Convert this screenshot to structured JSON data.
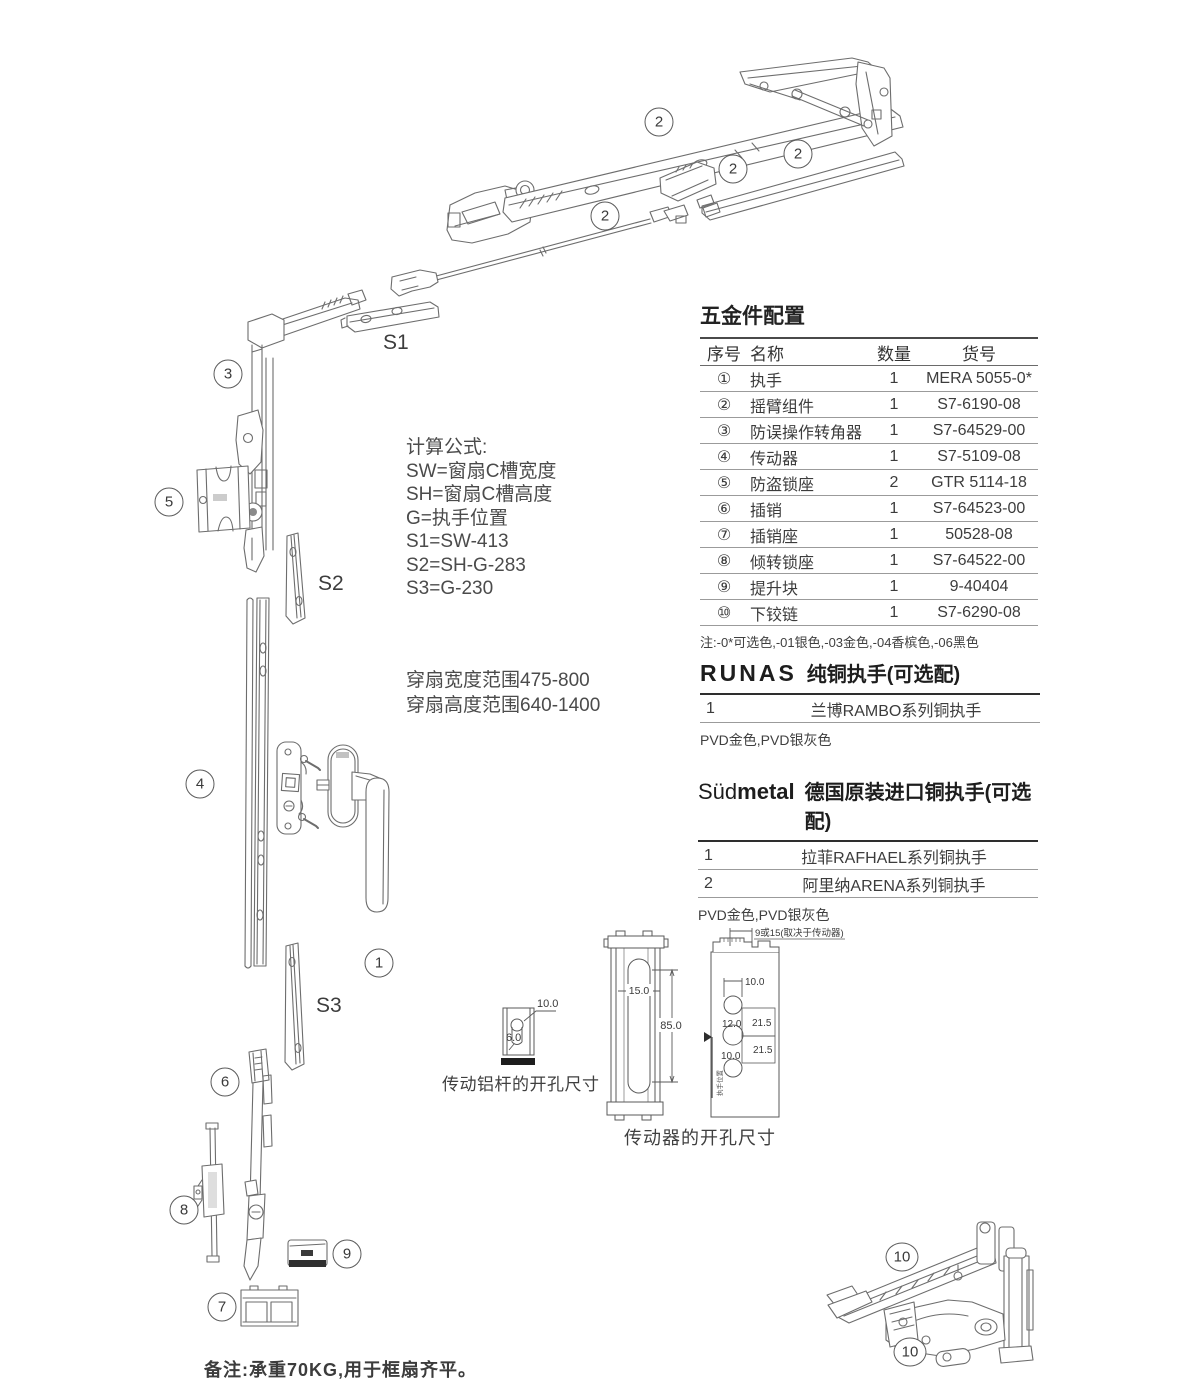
{
  "hardware_table": {
    "title": "五金件配置",
    "columns": [
      "序号",
      "名称",
      "数量",
      "货号"
    ],
    "rows": [
      {
        "no": "①",
        "name": "执手",
        "qty": "1",
        "code": "MERA 5055-0*"
      },
      {
        "no": "②",
        "name": "摇臂组件",
        "qty": "1",
        "code": "S7-6190-08"
      },
      {
        "no": "③",
        "name": "防误操作转角器",
        "qty": "1",
        "code": "S7-64529-00"
      },
      {
        "no": "④",
        "name": "传动器",
        "qty": "1",
        "code": "S7-5109-08"
      },
      {
        "no": "⑤",
        "name": "防盗锁座",
        "qty": "2",
        "code": "GTR 5114-18"
      },
      {
        "no": "⑥",
        "name": "插销",
        "qty": "1",
        "code": "S7-64523-00"
      },
      {
        "no": "⑦",
        "name": "插销座",
        "qty": "1",
        "code": "50528-08"
      },
      {
        "no": "⑧",
        "name": "倾转锁座",
        "qty": "1",
        "code": "S7-64522-00"
      },
      {
        "no": "⑨",
        "name": "提升块",
        "qty": "1",
        "code": "9-40404"
      },
      {
        "no": "⑩",
        "name": "下铰链",
        "qty": "1",
        "code": "S7-6290-08"
      }
    ],
    "note": "注:-0*可选色,-01银色,-03金色,-04香槟色,-06黑色"
  },
  "runas": {
    "brand": "RUNAS",
    "title": "纯铜执手(可选配)",
    "rows": [
      {
        "no": "1",
        "name": "兰博RAMBO系列铜执手"
      }
    ],
    "note": "PVD金色,PVD银灰色"
  },
  "sudmetal": {
    "brand_light": "Süd",
    "brand_bold": "metal",
    "title": "德国原装进口铜执手(可选配)",
    "rows": [
      {
        "no": "1",
        "name": "拉菲RAFHAEL系列铜执手"
      },
      {
        "no": "2",
        "name": "阿里纳ARENA系列铜执手"
      }
    ],
    "note": "PVD金色,PVD银灰色"
  },
  "formulas": {
    "title": "计算公式:",
    "l1": "SW=窗扇C槽宽度",
    "l2": "SH=窗扇C槽高度",
    "l3": "G=执手位置",
    "l4": "S1=SW-413",
    "l5": "S2=SH-G-283",
    "l6": "S3=G-230"
  },
  "range": {
    "l1": "穿扇宽度范围475-800",
    "l2": "穿扇高度范围640-1400"
  },
  "labels": {
    "s1": "S1",
    "s2": "S2",
    "s3": "S3"
  },
  "callouts": [
    "2",
    "2",
    "2",
    "2",
    "3",
    "5",
    "4",
    "1",
    "6",
    "8",
    "9",
    "7",
    "10",
    "10"
  ],
  "dims_rod": {
    "caption": "传动铝杆的开孔尺寸",
    "d10": "10.0",
    "d6": "6.0"
  },
  "dims_gear": {
    "caption": "传动器的开孔尺寸",
    "top_dim": "9或15(取决于传动器)",
    "w": "15.0",
    "h": "85.0",
    "d10a": "10.0",
    "d12": "12.0",
    "d215a": "21.5",
    "d215b": "21.5",
    "d10b": "10.0",
    "vlabel": "执手位置"
  },
  "footer_note": "备注:承重70KG,用于框扇齐平。"
}
